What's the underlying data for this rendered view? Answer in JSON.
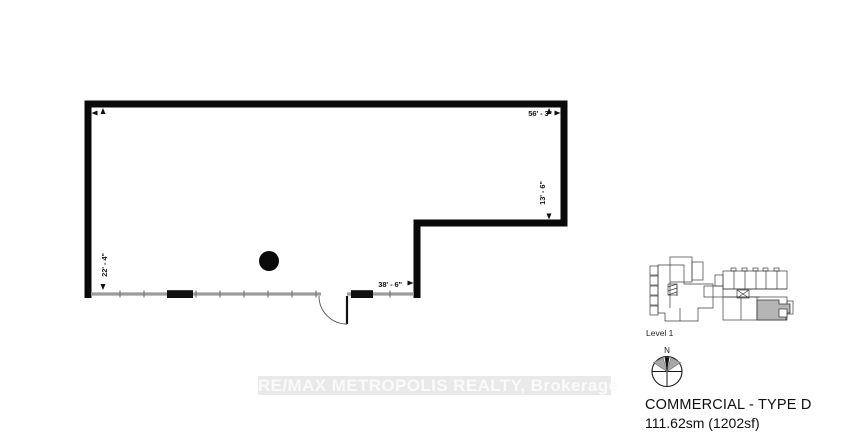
{
  "plan": {
    "dimensions": {
      "top_width": "56' - 3\"",
      "right_height": "13' - 6\"",
      "left_height": "22' - 4\"",
      "bottom_width": "38' - 6\""
    }
  },
  "key_plan": {
    "label": "Level 1"
  },
  "compass": {
    "north_label": "N"
  },
  "unit": {
    "type_label": "COMMERCIAL - TYPE D",
    "area_label": "111.62sm (1202sf)"
  },
  "watermark": {
    "text": "RE/MAX METROPOLIS REALTY, Brokerage"
  },
  "colors": {
    "wall": "#0a0a0a",
    "storefront_glazing": "#9c9c9c",
    "column": "#0a0a0a",
    "highlighted_unit": "#b5b5b5",
    "watermark_background": "#e9e9e9",
    "watermark_text": "#fafafa"
  }
}
